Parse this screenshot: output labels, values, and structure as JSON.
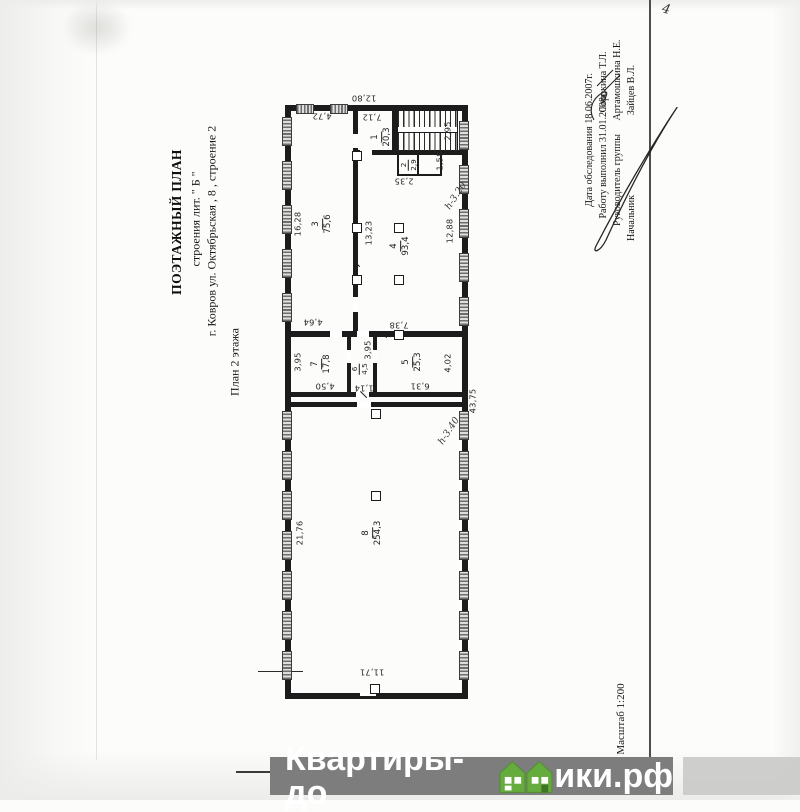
{
  "title": {
    "line1": "ПОЭТАЖНЫЙ ПЛАН",
    "line2": "строения лит. \" Б \"",
    "line3": "г. Ковров ул. Октябрьская , 8 , строение 2",
    "line4": "План 2 этажа"
  },
  "meta": {
    "row1_label": "Дата обследования 18.06.2007г.",
    "row2_label": "Работу выполнил 31.01.2008г.",
    "row2_name": "Сорокина Т.Л.",
    "row3_label": "Руководитель группы",
    "row3_name": "Артамошкина Н.Е.",
    "row4_label": "Начальник",
    "row4_name": "Зайцев В.Л.",
    "scale": "Масштаб 1:200",
    "page_mark": "4"
  },
  "plan": {
    "rooms": [
      {
        "num": "1",
        "area": "20,3"
      },
      {
        "num": "2",
        "area": "2,9"
      },
      {
        "num": "3",
        "area": "75,6"
      },
      {
        "num": "4",
        "area": "93,4"
      },
      {
        "num": "5",
        "area": "25,3"
      },
      {
        "num": "6",
        "area": "4,5"
      },
      {
        "num": "7",
        "area": "17,8"
      },
      {
        "num": "8",
        "area": "254,3"
      }
    ],
    "dims": {
      "building_width_top": "12,80",
      "room3_width_top": "4,72",
      "room1_width": "7,12",
      "stairs_depth": "2,95",
      "room2_width": "2,35",
      "room2_depth": "1,58",
      "room3_length": "16,28",
      "room4_length_inner": "13,23",
      "room4_length_right": "12,88",
      "room3_bottom": "4,64",
      "room4_bottom": "7,38",
      "room7_depth": "3,95",
      "room6_depth": "3,95",
      "room7_width": "4,50",
      "room6_width": "1,14",
      "room5_width": "6,31",
      "room5_depth": "4,02",
      "building_length_right": "43,75",
      "room8_length": "21,76",
      "room8_width": "11,71"
    },
    "notes": {
      "height_mark_1": "h-3.20",
      "height_mark_2": "h-3.40"
    }
  },
  "watermark": {
    "text_left": "Квартиры-до",
    "text_right": "ики.рф",
    "bar_gray": "#7d7d7d",
    "brand_green": "#66ab3e"
  }
}
